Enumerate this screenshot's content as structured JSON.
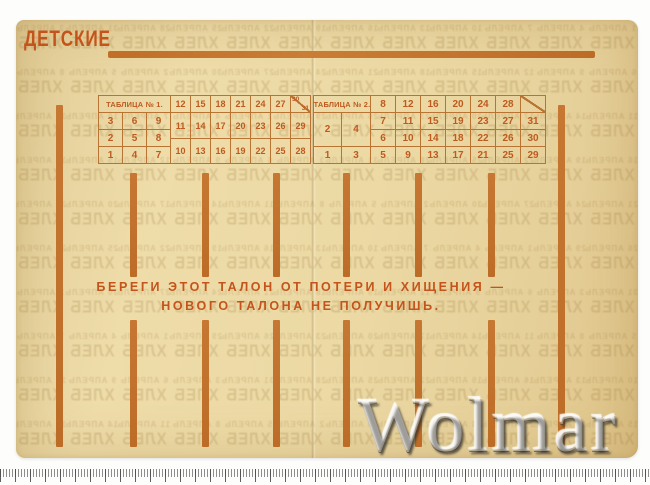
{
  "scan": {
    "title": "ДЕТСКИЕ",
    "warning_line1": "БЕРЕГИ ЭТОТ ТАЛОН ОТ ПОТЕРИ И ХИЩЕНИЯ —",
    "warning_line2": "НОВОГО ТАЛОНА НЕ ПОЛУЧИШЬ.",
    "ink_color": "#c4541b",
    "bar_color": "#bc6c26",
    "table_border_color": "#b97433",
    "number_color": "#bf5a1f",
    "paper_color": "#ecd9a4"
  },
  "tables": [
    {
      "header": "ТАБЛИЦА № 1.",
      "left_rows": [
        [
          "3",
          "6",
          "9"
        ],
        [
          "2",
          "5",
          "8"
        ],
        [
          "1",
          "4",
          "7"
        ]
      ],
      "right_rows": [
        [
          "12",
          "15",
          "18",
          "21",
          "24",
          "27"
        ],
        [
          "11",
          "14",
          "17",
          "20",
          "23",
          "26",
          "29"
        ],
        [
          "10",
          "13",
          "16",
          "19",
          "22",
          "25",
          "28"
        ]
      ],
      "diag_cell": {
        "top": "30",
        "bottom": "31"
      }
    },
    {
      "header": "ТАБЛИЦА № 2.",
      "left_tall_row": [
        "2",
        "4"
      ],
      "left_bottom_row": [
        "1",
        "3"
      ],
      "right_rows": [
        [
          "8",
          "12",
          "16",
          "20",
          "24",
          "28"
        ],
        [
          "7",
          "11",
          "15",
          "19",
          "23",
          "27",
          "31"
        ],
        [
          "6",
          "10",
          "14",
          "18",
          "22",
          "26",
          "30"
        ],
        [
          "5",
          "9",
          "13",
          "17",
          "21",
          "25",
          "29"
        ]
      ],
      "diag_cell": {
        "top": "",
        "bottom": ""
      }
    }
  ],
  "ghost_print": {
    "word": "ХЛЕБ",
    "month": "АПРЕЛЬ"
  },
  "watermark": {
    "text": "Wolmar"
  }
}
